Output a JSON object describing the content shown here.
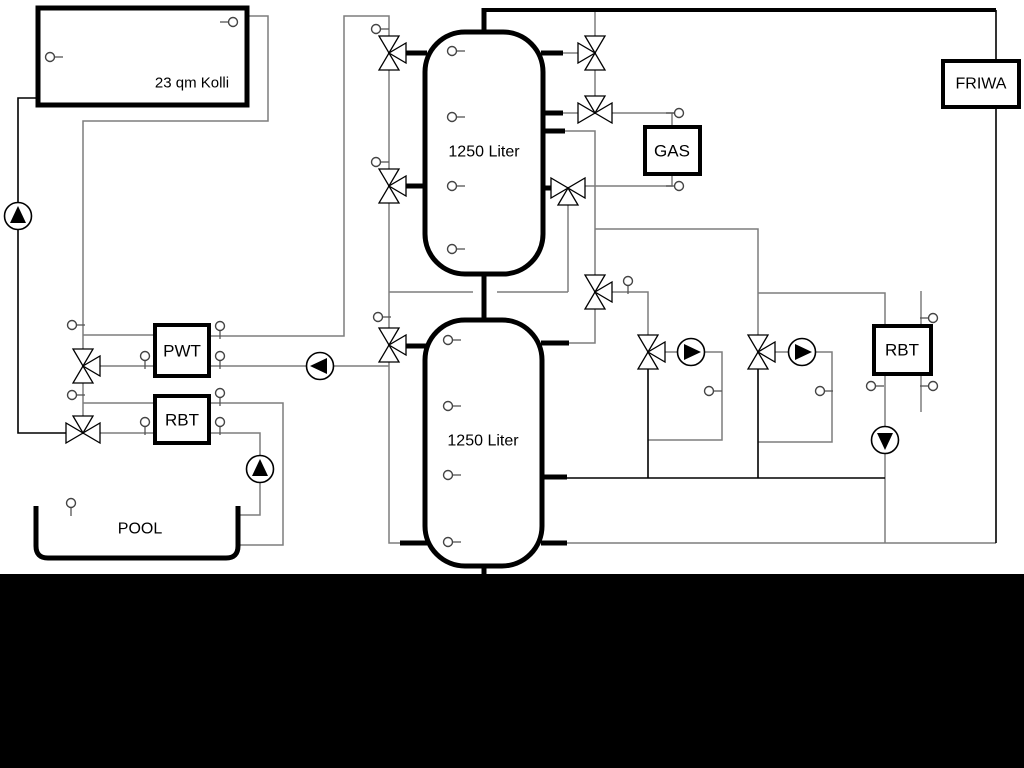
{
  "diagram": {
    "canvas": {
      "w": 1024,
      "h": 768,
      "background": "#ffffff"
    },
    "colors": {
      "pipe": "#7d7d7d",
      "pipe_dark": "#000000",
      "outline": "#000000",
      "panel": "#000000"
    },
    "boxes": [
      {
        "id": "collector",
        "label": "23 qm Kolli",
        "x": 38,
        "y": 8,
        "w": 209,
        "h": 97,
        "stroke": 5,
        "lx": 192,
        "ly": 83,
        "fs": 15
      },
      {
        "id": "pwt",
        "label": "PWT",
        "x": 155,
        "y": 325,
        "w": 54,
        "h": 51,
        "stroke": 4,
        "lx": 182,
        "ly": 351,
        "fs": 17
      },
      {
        "id": "rbt-left",
        "label": "RBT",
        "x": 155,
        "y": 396,
        "w": 54,
        "h": 47,
        "stroke": 4,
        "lx": 182,
        "ly": 420,
        "fs": 17
      },
      {
        "id": "gas",
        "label": "GAS",
        "x": 645,
        "y": 127,
        "w": 55,
        "h": 47,
        "stroke": 4,
        "lx": 672,
        "ly": 151,
        "fs": 17
      },
      {
        "id": "friwa",
        "label": "FRIWA",
        "x": 943,
        "y": 61,
        "w": 76,
        "h": 46,
        "stroke": 4,
        "lx": 981,
        "ly": 84,
        "fs": 16
      },
      {
        "id": "rbt-right",
        "label": "RBT",
        "x": 874,
        "y": 326,
        "w": 57,
        "h": 48,
        "stroke": 4,
        "lx": 902,
        "ly": 350,
        "fs": 17
      }
    ],
    "tanks": [
      {
        "id": "buffer-tank-1",
        "label": "1250 Liter",
        "x": 425,
        "y": 32,
        "w": 118,
        "h": 242,
        "r": 40,
        "lx": 484,
        "ly": 152,
        "fs": 16
      },
      {
        "id": "buffer-tank-2",
        "label": "1250 Liter",
        "x": 425,
        "y": 320,
        "w": 117,
        "h": 246,
        "r": 40,
        "lx": 483,
        "ly": 441,
        "fs": 16
      }
    ],
    "pool": {
      "id": "pool",
      "label": "POOL",
      "lx": 140,
      "ly": 529,
      "fs": 16,
      "path": "M 36 506 L 36 546 Q 36 558 48 558 L 226 558 Q 238 558 238 546 L 238 506"
    },
    "pipes_gray": [
      [
        [
          247,
          16
        ],
        [
          268,
          16
        ],
        [
          268,
          121
        ],
        [
          83,
          121
        ],
        [
          83,
          349
        ]
      ],
      [
        [
          83,
          335
        ],
        [
          155,
          335
        ]
      ],
      [
        [
          209,
          336
        ],
        [
          344,
          336
        ],
        [
          344,
          16
        ],
        [
          389,
          16
        ],
        [
          389,
          36
        ]
      ],
      [
        [
          100,
          366
        ],
        [
          155,
          366
        ]
      ],
      [
        [
          209,
          366
        ],
        [
          307,
          366
        ]
      ],
      [
        [
          333,
          366
        ],
        [
          389,
          366
        ]
      ],
      [
        [
          83,
          383
        ],
        [
          83,
          416
        ]
      ],
      [
        [
          83,
          403
        ],
        [
          155,
          403
        ]
      ],
      [
        [
          209,
          403
        ],
        [
          283,
          403
        ],
        [
          283,
          545
        ],
        [
          238,
          545
        ]
      ],
      [
        [
          100,
          433
        ],
        [
          155,
          433
        ]
      ],
      [
        [
          209,
          433
        ],
        [
          260,
          433
        ],
        [
          260,
          456
        ]
      ],
      [
        [
          260,
          482
        ],
        [
          260,
          515
        ],
        [
          238,
          515
        ]
      ],
      [
        [
          389,
          70
        ],
        [
          389,
          169
        ]
      ],
      [
        [
          389,
          203
        ],
        [
          389,
          328
        ]
      ],
      [
        [
          389,
          362
        ],
        [
          389,
          543
        ],
        [
          400,
          543
        ]
      ],
      [
        [
          389,
          292
        ],
        [
          473,
          292
        ]
      ],
      [
        [
          497,
          292
        ],
        [
          568,
          292
        ]
      ],
      [
        [
          568,
          292
        ],
        [
          568,
          205
        ]
      ],
      [
        [
          578,
          53
        ],
        [
          563,
          53
        ]
      ],
      [
        [
          595,
          10
        ],
        [
          595,
          36
        ]
      ],
      [
        [
          595,
          70
        ],
        [
          595,
          96
        ]
      ],
      [
        [
          578,
          113
        ],
        [
          563,
          113
        ]
      ],
      [
        [
          612,
          113
        ],
        [
          674,
          113
        ]
      ],
      [
        [
          672,
          113
        ],
        [
          672,
          127
        ]
      ],
      [
        [
          672,
          173
        ],
        [
          672,
          186
        ],
        [
          585,
          186
        ]
      ],
      [
        [
          565,
          131
        ],
        [
          595,
          131
        ],
        [
          595,
          275
        ]
      ],
      [
        [
          595,
          229
        ],
        [
          758,
          229
        ],
        [
          758,
          335
        ]
      ],
      [
        [
          758,
          293
        ],
        [
          885,
          293
        ],
        [
          885,
          326
        ]
      ],
      [
        [
          612,
          292
        ],
        [
          648,
          292
        ],
        [
          648,
          335
        ]
      ],
      [
        [
          595,
          309
        ],
        [
          595,
          343
        ],
        [
          569,
          343
        ]
      ],
      [
        [
          665,
          352
        ],
        [
          678,
          352
        ]
      ],
      [
        [
          704,
          352
        ],
        [
          722,
          352
        ],
        [
          722,
          440
        ],
        [
          648,
          440
        ]
      ],
      [
        [
          775,
          352
        ],
        [
          789,
          352
        ]
      ],
      [
        [
          815,
          352
        ],
        [
          832,
          352
        ],
        [
          832,
          442
        ],
        [
          758,
          442
        ]
      ],
      [
        [
          885,
          374
        ],
        [
          885,
          427
        ]
      ],
      [
        [
          885,
          453
        ],
        [
          885,
          543
        ]
      ],
      [
        [
          567,
          543
        ],
        [
          996,
          543
        ]
      ],
      [
        [
          921,
          291
        ],
        [
          921,
          412
        ]
      ]
    ],
    "pipes_dark": [
      [
        [
          38,
          98
        ],
        [
          18,
          98
        ],
        [
          18,
          203
        ]
      ],
      [
        [
          18,
          229
        ],
        [
          18,
          433
        ],
        [
          67,
          433
        ]
      ],
      [
        [
          648,
          369
        ],
        [
          648,
          478
        ]
      ],
      [
        [
          758,
          369
        ],
        [
          758,
          478
        ]
      ],
      [
        [
          567,
          478
        ],
        [
          885,
          478
        ]
      ],
      [
        [
          996,
          10
        ],
        [
          996,
          543
        ]
      ]
    ],
    "pipes_thick": [
      {
        "pts": [
          [
            484,
            10
          ],
          [
            996,
            10
          ]
        ],
        "w": 4
      },
      {
        "pts": [
          [
            484,
            8
          ],
          [
            484,
            34
          ]
        ],
        "w": 5
      },
      {
        "pts": [
          [
            484,
            272
          ],
          [
            484,
            322
          ]
        ],
        "w": 5
      },
      {
        "pts": [
          [
            484,
            564
          ],
          [
            484,
            576
          ]
        ],
        "w": 5
      },
      {
        "pts": [
          [
            403,
            53
          ],
          [
            427,
            53
          ]
        ],
        "w": 5
      },
      {
        "pts": [
          [
            403,
            186
          ],
          [
            427,
            186
          ]
        ],
        "w": 5
      },
      {
        "pts": [
          [
            541,
            53
          ],
          [
            563,
            53
          ]
        ],
        "w": 5
      },
      {
        "pts": [
          [
            541,
            113
          ],
          [
            563,
            113
          ]
        ],
        "w": 5
      },
      {
        "pts": [
          [
            541,
            131
          ],
          [
            565,
            131
          ]
        ],
        "w": 5
      },
      {
        "pts": [
          [
            541,
            188
          ],
          [
            552,
            188
          ]
        ],
        "w": 5
      },
      {
        "pts": [
          [
            403,
            346
          ],
          [
            427,
            346
          ]
        ],
        "w": 5
      },
      {
        "pts": [
          [
            541,
            343
          ],
          [
            569,
            343
          ]
        ],
        "w": 5
      },
      {
        "pts": [
          [
            541,
            477
          ],
          [
            567,
            477
          ]
        ],
        "w": 5
      },
      {
        "pts": [
          [
            400,
            543
          ],
          [
            427,
            543
          ]
        ],
        "w": 5
      },
      {
        "pts": [
          [
            541,
            543
          ],
          [
            567,
            543
          ]
        ],
        "w": 5
      }
    ],
    "valves": [
      {
        "x": 389,
        "y": 53,
        "axis": "v",
        "third": "right"
      },
      {
        "x": 389,
        "y": 186,
        "axis": "v",
        "third": "right"
      },
      {
        "x": 389,
        "y": 345,
        "axis": "v",
        "third": "right"
      },
      {
        "x": 595,
        "y": 53,
        "axis": "v",
        "third": "left"
      },
      {
        "x": 595,
        "y": 113,
        "axis": "h",
        "third": "top"
      },
      {
        "x": 568,
        "y": 188,
        "axis": "h",
        "third": "bottom"
      },
      {
        "x": 595,
        "y": 292,
        "axis": "v",
        "third": "right"
      },
      {
        "x": 648,
        "y": 352,
        "axis": "v",
        "third": "right"
      },
      {
        "x": 758,
        "y": 352,
        "axis": "v",
        "third": "right"
      },
      {
        "x": 83,
        "y": 366,
        "axis": "v",
        "third": "right"
      },
      {
        "x": 83,
        "y": 433,
        "axis": "h",
        "third": "top"
      }
    ],
    "pumps": [
      {
        "x": 18,
        "y": 216,
        "dir": "up"
      },
      {
        "x": 320,
        "y": 366,
        "dir": "left"
      },
      {
        "x": 260,
        "y": 469,
        "dir": "up"
      },
      {
        "x": 691,
        "y": 352,
        "dir": "right"
      },
      {
        "x": 802,
        "y": 352,
        "dir": "right"
      },
      {
        "x": 885,
        "y": 440,
        "dir": "down"
      }
    ],
    "sensors": [
      {
        "x": 233,
        "y": 22,
        "stem": "left"
      },
      {
        "x": 50,
        "y": 57,
        "stem": "right"
      },
      {
        "x": 452,
        "y": 51,
        "stem": "right"
      },
      {
        "x": 452,
        "y": 117,
        "stem": "right"
      },
      {
        "x": 452,
        "y": 186,
        "stem": "right"
      },
      {
        "x": 452,
        "y": 249,
        "stem": "right"
      },
      {
        "x": 448,
        "y": 340,
        "stem": "right"
      },
      {
        "x": 448,
        "y": 406,
        "stem": "right"
      },
      {
        "x": 448,
        "y": 475,
        "stem": "right"
      },
      {
        "x": 448,
        "y": 542,
        "stem": "right"
      },
      {
        "x": 376,
        "y": 29,
        "stem": "right"
      },
      {
        "x": 376,
        "y": 162,
        "stem": "right"
      },
      {
        "x": 378,
        "y": 317,
        "stem": "right"
      },
      {
        "x": 72,
        "y": 325,
        "stem": "right"
      },
      {
        "x": 72,
        "y": 395,
        "stem": "right"
      },
      {
        "x": 145,
        "y": 356,
        "stem": "down"
      },
      {
        "x": 220,
        "y": 326,
        "stem": "down"
      },
      {
        "x": 220,
        "y": 356,
        "stem": "down"
      },
      {
        "x": 145,
        "y": 422,
        "stem": "down"
      },
      {
        "x": 220,
        "y": 393,
        "stem": "down"
      },
      {
        "x": 220,
        "y": 422,
        "stem": "down"
      },
      {
        "x": 71,
        "y": 503,
        "stem": "down"
      },
      {
        "x": 628,
        "y": 281,
        "stem": "down"
      },
      {
        "x": 679,
        "y": 113,
        "stem": "left"
      },
      {
        "x": 679,
        "y": 186,
        "stem": "left"
      },
      {
        "x": 709,
        "y": 391,
        "stem": "right"
      },
      {
        "x": 820,
        "y": 391,
        "stem": "right"
      },
      {
        "x": 871,
        "y": 386,
        "stem": "right"
      },
      {
        "x": 933,
        "y": 318,
        "stem": "left"
      },
      {
        "x": 933,
        "y": 386,
        "stem": "left"
      }
    ],
    "panel": {
      "x": 0,
      "y": 574,
      "w": 1024,
      "h": 194
    }
  }
}
